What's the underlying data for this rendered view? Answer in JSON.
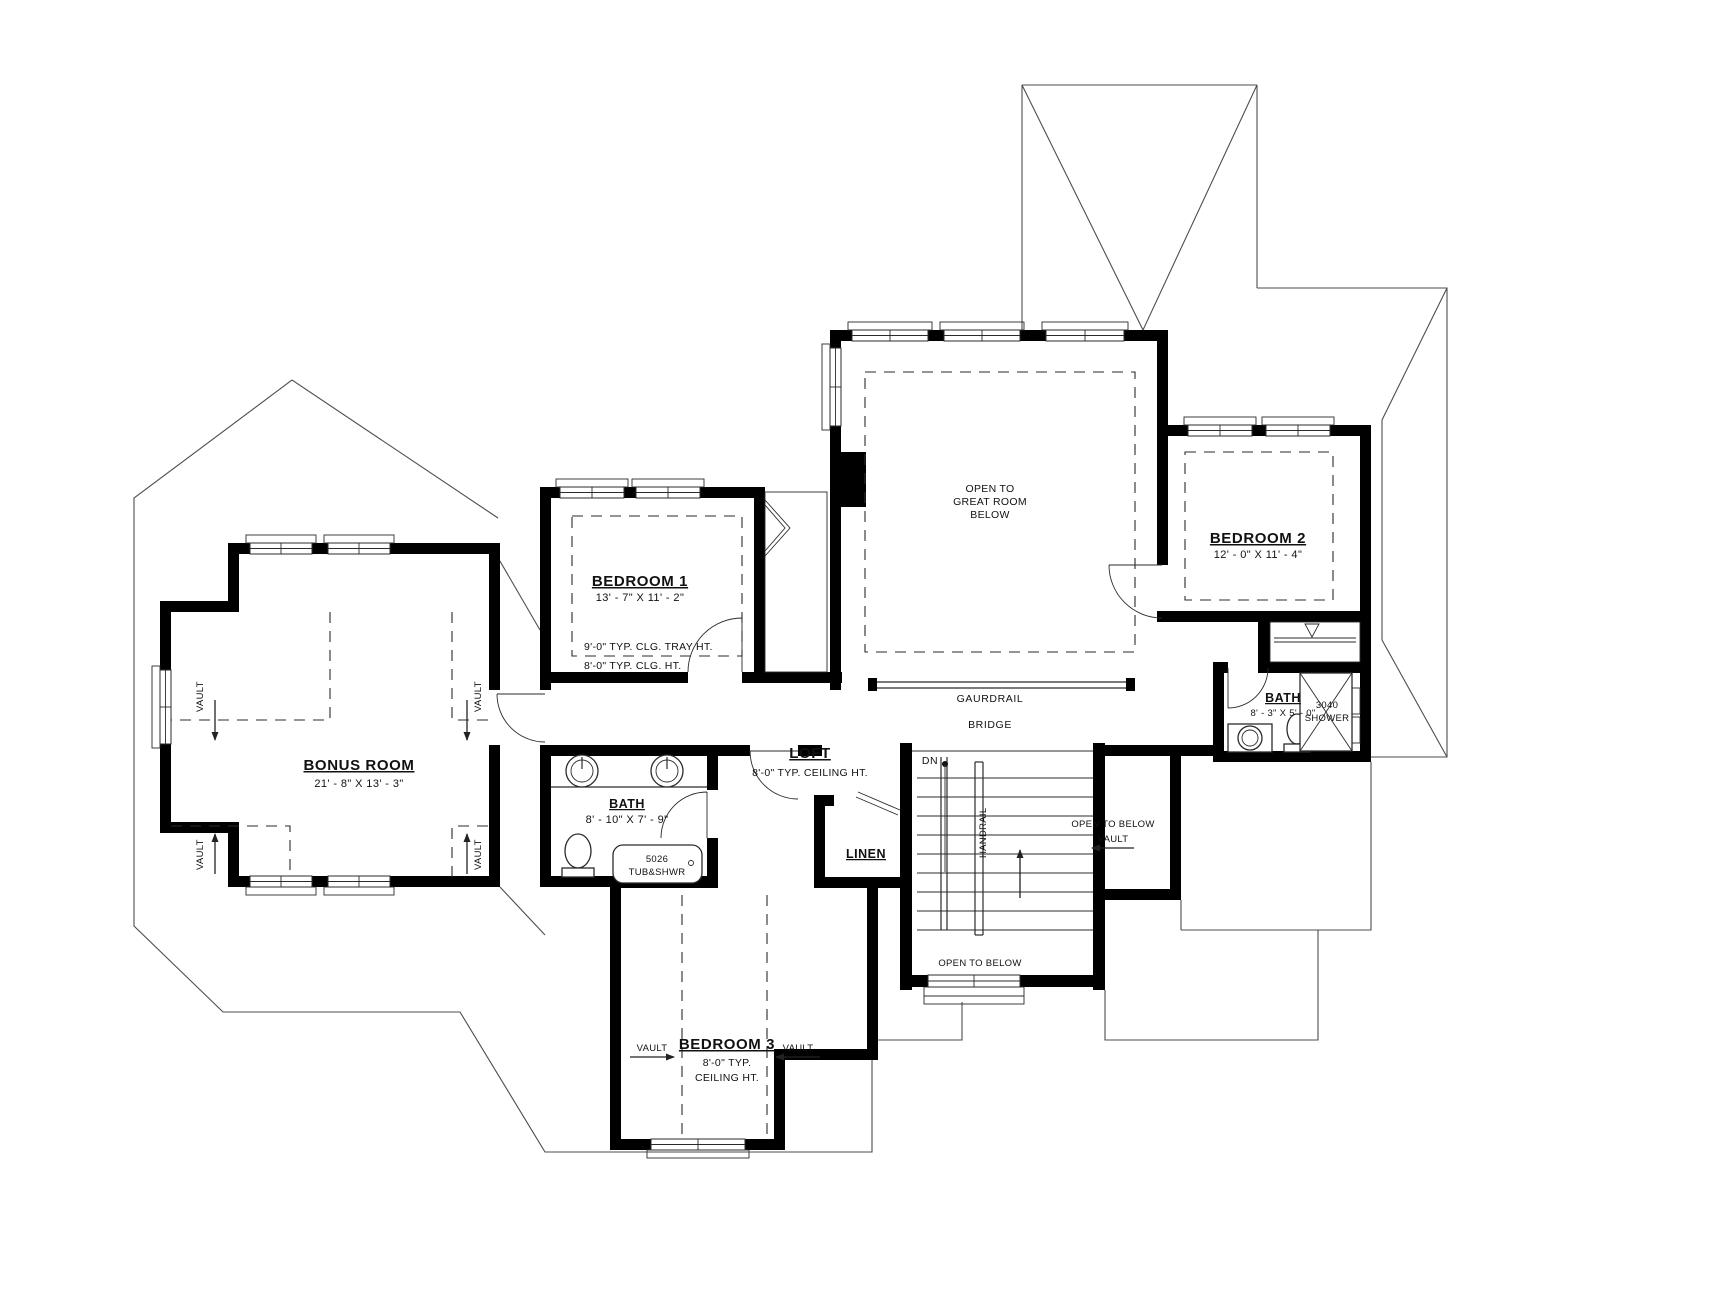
{
  "plan": {
    "rooms": {
      "bonus": {
        "title": "BONUS ROOM",
        "dims": "21' - 8\" X 13' - 3\""
      },
      "bedroom1": {
        "title": "BEDROOM 1",
        "dims": "13' - 7\" X 11' - 2\"",
        "note_tray": "9'-0\" TYP. CLG. TRAY HT.",
        "note_clg": "8'-0\" TYP. CLG. HT."
      },
      "great": {
        "line1": "OPEN TO",
        "line2": "GREAT ROOM",
        "line3": "BELOW"
      },
      "bedroom2": {
        "title": "BEDROOM 2",
        "dims": "12' - 0\" X 11' - 4\""
      },
      "bath2": {
        "title": "BATH",
        "dims": "8' - 3\" X 5' - 0\"",
        "shower1": "3040",
        "shower2": "SHOWER"
      },
      "loft": {
        "title": "LOFT",
        "note": "8'-0\" TYP. CEILING HT."
      },
      "bath1": {
        "title": "BATH",
        "dims": "8' - 10\" X 7' - 9\"",
        "tub1": "5026",
        "tub2": "TUB&SHWR"
      },
      "linen": {
        "title": "LINEN"
      },
      "bedroom3": {
        "title": "BEDROOM 3",
        "note1": "8'-0\" TYP.",
        "note2": "CEILING HT."
      }
    },
    "annotations": {
      "guardrail": "GAURDRAIL",
      "bridge": "BRIDGE",
      "dn": "DN",
      "handrail": "HANDRAIL",
      "open_below_stair": "OPEN TO BELOW",
      "open_below_vault_1": "OPEN TO BELOW",
      "open_below_vault_2": "VAULT",
      "vault": "VAULT"
    },
    "colors": {
      "wall": "#000000",
      "line": "#2b2b2b",
      "background": "#ffffff"
    }
  }
}
